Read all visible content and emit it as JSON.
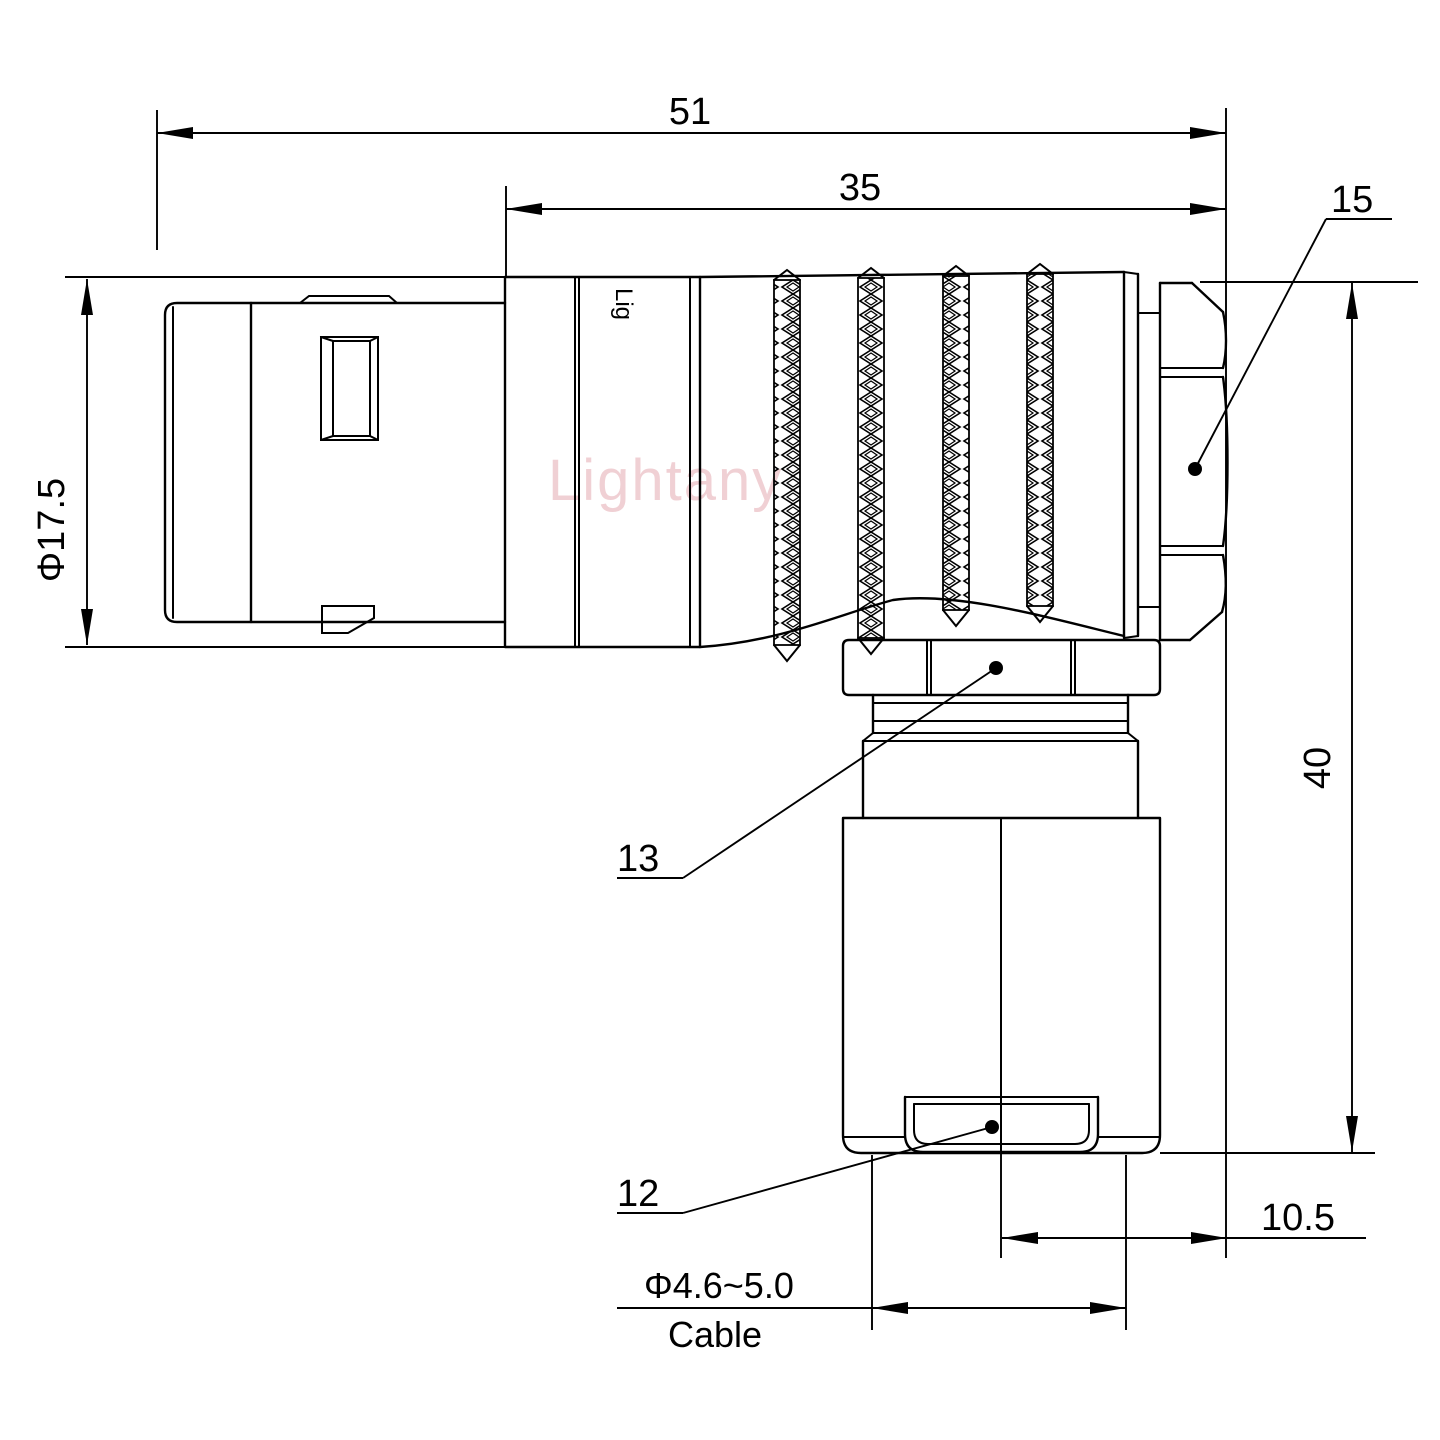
{
  "drawing": {
    "watermark": "Lightany",
    "body_marking": "Lig",
    "dims": {
      "overall_length": "51",
      "body_length": "35",
      "backnut_ref": "15",
      "shell_diameter": "Φ17.5",
      "height": "40",
      "cable_offset": "10.5",
      "cable_diameter": "Φ4.6~5.0",
      "cable_caption": "Cable",
      "clamp_nut_ref": "13",
      "bushing_ref": "12"
    },
    "colors": {
      "line": "#000000",
      "watermark": "#f0d0d4",
      "background": "#ffffff"
    }
  }
}
